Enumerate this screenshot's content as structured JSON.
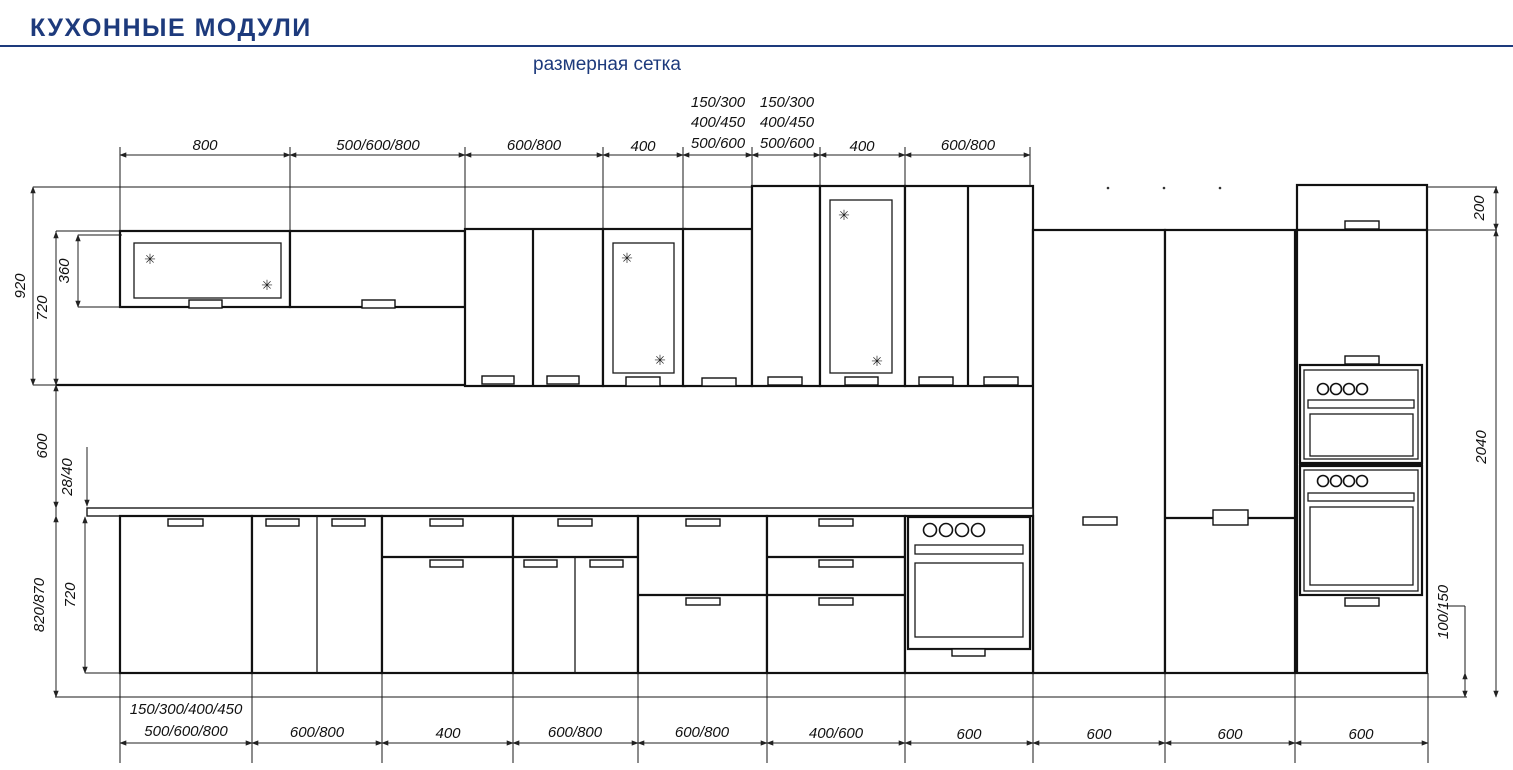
{
  "header": {
    "title": "КУХОННЫЕ МОДУЛИ",
    "subtitle": "размерная сетка",
    "accent_color": "#1d3a7c"
  },
  "symbols": {
    "glass_mark": "✳"
  },
  "dims": {
    "top": [
      "800",
      "500/600/800",
      "600/800",
      "400",
      {
        "lines": [
          "150/300",
          "400/450",
          "500/600"
        ]
      },
      {
        "lines": [
          "150/300",
          "400/450",
          "500/600"
        ]
      },
      "400",
      "600/800"
    ],
    "bottom": [
      {
        "lines": [
          "150/300/400/450",
          "500/600/800"
        ]
      },
      "600/800",
      "400",
      "600/800",
      "600/800",
      "400/600",
      "600",
      "600",
      "600",
      "600"
    ],
    "left": [
      "920",
      "720",
      "360",
      "600",
      "28/40",
      "820/870",
      "720"
    ],
    "right": [
      "200",
      "2040",
      "100/150"
    ]
  }
}
